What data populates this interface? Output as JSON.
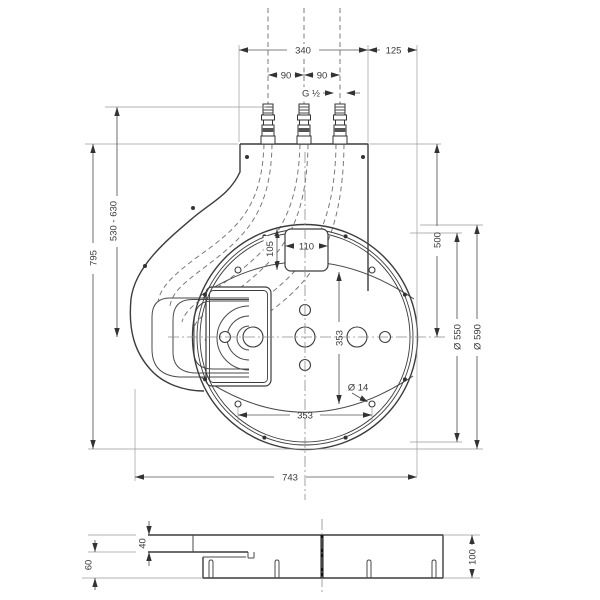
{
  "dims": {
    "top_width": "340",
    "right_offset": "125",
    "pipe_gap_left": "90",
    "pipe_gap_right": "90",
    "thread": "G ½",
    "supply_height": "530 - 630",
    "overall_height": "795",
    "plate_to_center": "500",
    "cutout_width": "110",
    "cutout_depth": "105",
    "hole_spacing_vertical": "353",
    "hole_spacing_horizontal": "353",
    "hole_diameter": "Ø 14",
    "inner_diameter": "Ø 550",
    "outer_diameter": "Ø 590",
    "overall_width": "743",
    "deck_thickness": "40",
    "base_height": "60",
    "side_total_height": "100"
  }
}
